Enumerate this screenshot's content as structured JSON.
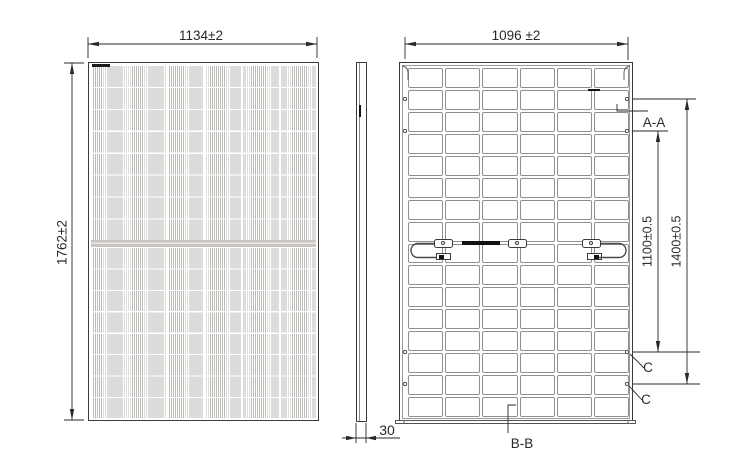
{
  "title": "Solar module outline drawing",
  "dimensions": {
    "front_width": "1134±2",
    "front_height": "1762±2",
    "back_width": "1096 ±2",
    "mount_span_inner": "1100±0.5",
    "mount_span_outer": "1400±0.5",
    "frame_thickness": "30"
  },
  "sections": {
    "aa": "A-A",
    "bb": "B-B",
    "c_upper": "C",
    "c_lower": "C"
  },
  "grid": {
    "front": {
      "cols": 6,
      "rows_top": 8,
      "rows_bottom": 8
    },
    "back": {
      "cols": 6,
      "rows": 16
    }
  },
  "colors": {
    "line": "#2a2a2a",
    "grid_line": "#8f8f8f",
    "cell_stripe": "#bdb9b5",
    "center_band": "#c9c5c1"
  }
}
